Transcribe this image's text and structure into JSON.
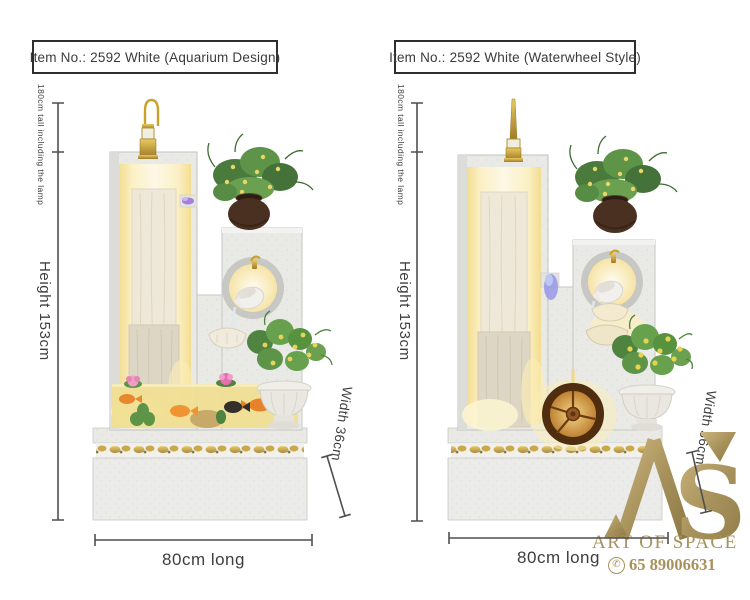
{
  "panels": [
    {
      "header": "Item No.: 2592 White (Aquarium Design)",
      "labels": {
        "total_height": "180cm tall including the lamp",
        "height": "Height 153cm",
        "width": "Width 36cm",
        "length": "80cm long"
      },
      "product": "white-stone-fountain-aquarium-design"
    },
    {
      "header": "Item No.: 2592 White (Waterwheel Style)",
      "labels": {
        "total_height": "180cm tall including the lamp",
        "height": "Height 153cm",
        "width": "Width 36cm",
        "length": "80cm long"
      },
      "product": "white-stone-fountain-waterwheel-style"
    }
  ],
  "watermark": {
    "monogram": "AS",
    "monogram_s": "S",
    "brand": "ART OF SPACE",
    "phone": "65 89006631",
    "icon": "phone-circle-icon"
  },
  "style": {
    "dimension_line_color": "#4f4f4f",
    "dimension_text_color": "#3e3e3e",
    "header_border_color": "#2e2e2e",
    "watermark_gold": "#a8925c",
    "glow_warm": "#f7e7a6",
    "stone": "#e9e9e6"
  }
}
